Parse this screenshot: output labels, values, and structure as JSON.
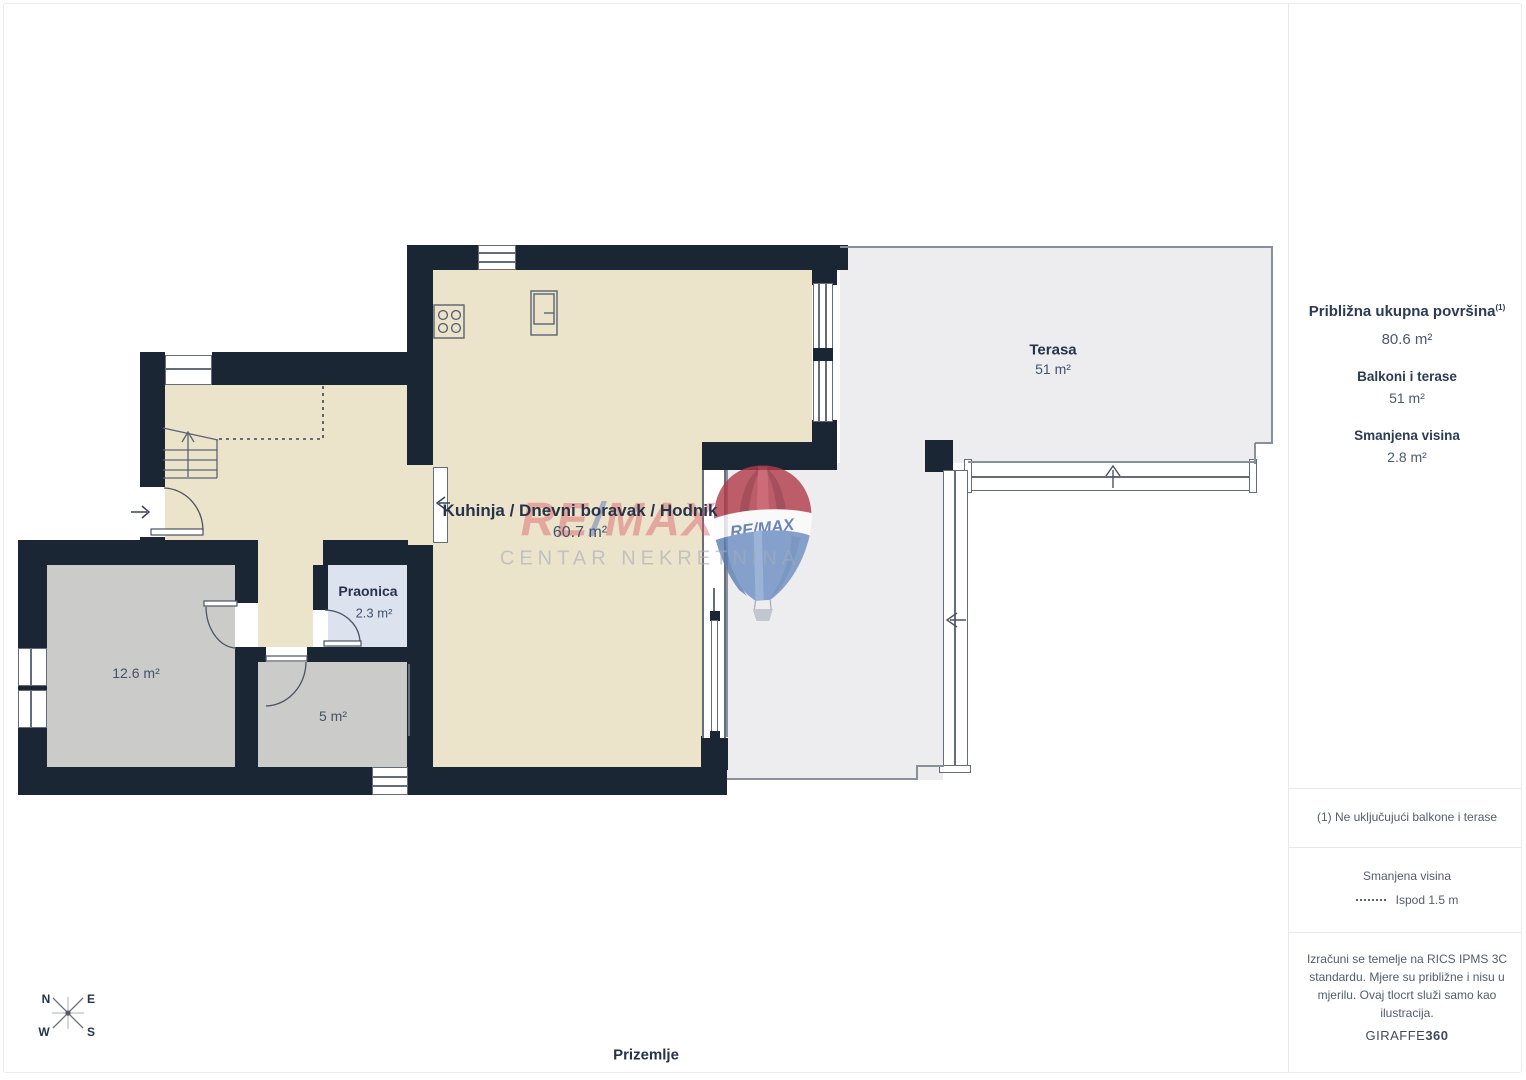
{
  "floorplan": {
    "floor_label": "Prizemlje",
    "rooms": {
      "main": {
        "name": "Kuhinja / Dnevni boravak / Hodnik",
        "area": "60.7 m²"
      },
      "terrace": {
        "name": "Terasa",
        "area": "51 m²"
      },
      "laundry": {
        "name": "Praonica",
        "area": "2.3 m²"
      },
      "room_left": {
        "area": "12.6 m²"
      },
      "room_small": {
        "area": "5 m²"
      }
    },
    "compass": {
      "n": "N",
      "e": "E",
      "s": "S",
      "w": "W"
    }
  },
  "watermark": {
    "brand_re": "RE",
    "brand_slash": "/",
    "brand_max": "MAX",
    "subtitle": "CENTAR NEKRETNINA",
    "balloon_text": "RE/MAX"
  },
  "sidebar": {
    "total_label": "Približna ukupna površina",
    "total_superscript": "(1)",
    "total_value": "80.6 m²",
    "balconies_label": "Balkoni i terase",
    "balconies_value": "51 m²",
    "reduced_label": "Smanjena visina",
    "reduced_value": "2.8 m²",
    "footnote": "(1) Ne uključujući balkone i terase",
    "legend_title": "Smanjena visina",
    "legend_value": "Ispod 1.5 m",
    "disclaimer": "Izračuni se temelje na RICS IPMS 3C standardu. Mjere su približne i nisu u mjerilu. Ovaj tlocrt služi samo kao ilustracija.",
    "brand_name": "GIRAFFE",
    "brand_suffix": "360"
  },
  "colors": {
    "wall": "#1b2634",
    "interior_floor": "#ece3cb",
    "secondary_room_floor": "#cbcbc9",
    "laundry_floor": "#dce3ef",
    "terrace_floor": "#ededf0",
    "brand_red": "#d8545c",
    "brand_blue": "#5c79bc"
  }
}
